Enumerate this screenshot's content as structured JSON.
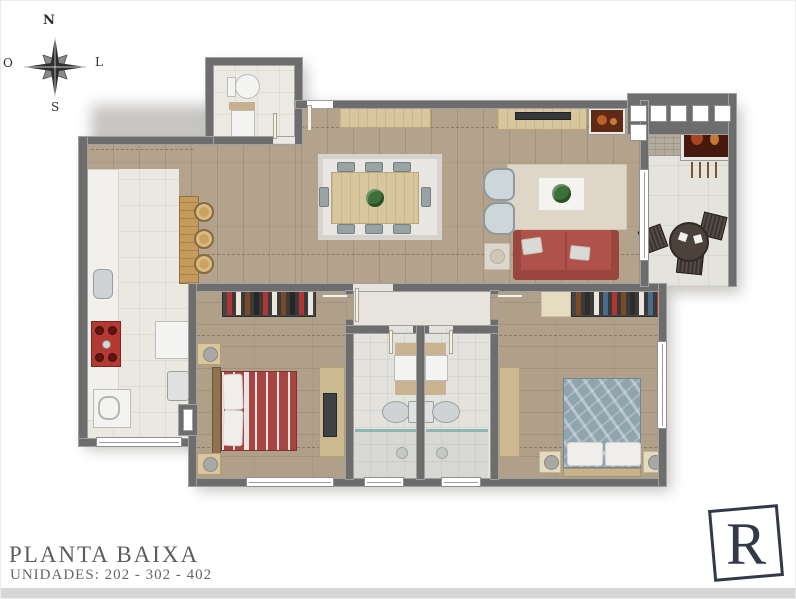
{
  "compass": {
    "north": "N",
    "south": "S",
    "west": "O",
    "east": "L"
  },
  "footer": {
    "title": "PLANTA BAIXA",
    "subtitle": "UNIDADES: 202 - 302 - 402"
  },
  "logo": {
    "letter": "R"
  },
  "icons": {
    "compass_rose": "eight-point-star",
    "logo_frame": "tilted-square"
  },
  "colors": {
    "wall": "#6d6d6d",
    "wood": "#b3a28c",
    "woodBed": "#b1a089",
    "tileKitchen": "#ebe8e1",
    "tileBath": "#e3e2dd",
    "tileHall": "#e7e4dd",
    "tileBalcony": "#e4e3dd",
    "tileLavabo": "#ece9e2",
    "counter": "#f1f0ec",
    "rugDining": "#e9e7e3",
    "rugLiving": "#ded6c6",
    "sofaRed": "#b0514b",
    "bedRed": "#a64542",
    "bedBlue": "#90a4ae",
    "armchair": "#cdd6d8",
    "furnWood": "#cdb98f",
    "barWood": "#c49a5d",
    "cooktop": "#b23a32",
    "plant": "#3d7038",
    "darkFurn": "#3b342e",
    "logoNavy": "#323949",
    "titleGray": "#5c5c5c",
    "bottomBar": "#d6d6d6"
  }
}
